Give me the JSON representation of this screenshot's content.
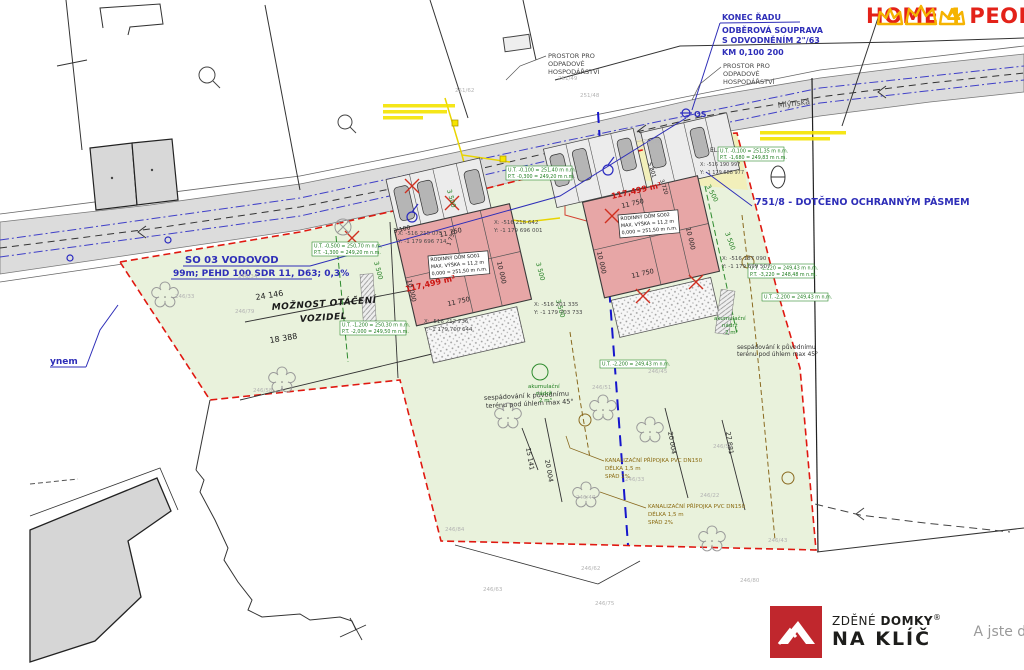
{
  "branding": {
    "home4people": {
      "home": "HOME",
      "four": "4",
      "people": "PEOPLE"
    },
    "naklic": {
      "zdene": "ZDĚNÉ",
      "domky": "DOMKY",
      "reg": "®",
      "naklic": "NA KLÍČ",
      "tagline": "A jste doma."
    }
  },
  "colors": {
    "accent_blue": "#2e2eb8",
    "parcel_green": "#e9f2dc",
    "building_pink": "#e7a6a6",
    "boundary_red": "#e01810",
    "road_gray": "#dcdcdc"
  },
  "buildings": {
    "so01": {
      "title": "RODINNÝ DŮM SO01",
      "height": "MAX. VÝŠKA = 11,2 m",
      "level": "0,000 = 251,50 m n.m.",
      "area": "117,499 m²"
    },
    "so02": {
      "title": "RODINNÝ DŮM SO02",
      "height": "MAX. VÝŠKA = 11,2 m",
      "level": "0,000 = 251,50 m n.m.",
      "area": "117,499 m²"
    }
  },
  "labels": [
    {
      "t": "KONEC ŘADU",
      "x": 722,
      "y": 20,
      "c": "blue",
      "s": 8,
      "n": "note-konec-radu"
    },
    {
      "t": "ODBĚROVÁ SOUPRAVA",
      "x": 722,
      "y": 33,
      "c": "blue",
      "s": 8,
      "n": "note-odberova-souprava"
    },
    {
      "t": "S ODVODNĚNÍM 2\"/63",
      "x": 722,
      "y": 43,
      "c": "blue",
      "s": 8,
      "n": "note-odvodneni"
    },
    {
      "t": "KM 0,100 200",
      "x": 722,
      "y": 55,
      "c": "blue",
      "s": 8,
      "n": "note-km"
    },
    {
      "t": "751/8 - DOTČENO OCHRANNÝM PÁSMEM",
      "x": 755,
      "y": 205,
      "c": "blue",
      "s": 9.5,
      "n": "note-ochranne-pasmo"
    },
    {
      "t": "SO 03 VODOVOD",
      "x": 185,
      "y": 263,
      "c": "blue",
      "s": 10,
      "n": "note-so03-vodovod"
    },
    {
      "t": "99m; PEHD 100 SDR 11, D63; 0,3%",
      "x": 173,
      "y": 276,
      "c": "blue",
      "s": 9,
      "n": "note-so03-spec"
    },
    {
      "t": "ynem",
      "x": 50,
      "y": 364,
      "c": "blue",
      "s": 9,
      "n": "note-ynem"
    },
    {
      "t": "OS",
      "x": 694,
      "y": 117,
      "c": "blue",
      "s": 8,
      "n": "note-os"
    },
    {
      "t": "PROSTOR PRO",
      "x": 548,
      "y": 58,
      "c": "note",
      "s": 6.5
    },
    {
      "t": "ODPADOVÉ",
      "x": 548,
      "y": 66,
      "c": "note",
      "s": 6.5
    },
    {
      "t": "HOSPODÁŘSTVÍ",
      "x": 548,
      "y": 74,
      "c": "note",
      "s": 6.5
    },
    {
      "t": "PROSTOR PRO",
      "x": 723,
      "y": 68,
      "c": "note",
      "s": 6.5
    },
    {
      "t": "ODPADOVÉ",
      "x": 723,
      "y": 76,
      "c": "note",
      "s": 6.5
    },
    {
      "t": "HOSPODÁŘSTVÍ",
      "x": 723,
      "y": 84,
      "c": "note",
      "s": 6.5
    },
    {
      "t": "Mlýnská",
      "x": 778,
      "y": 108,
      "r": -7,
      "c": "street",
      "s": 8,
      "n": "street-name"
    },
    {
      "t": "MOŽNOST OTÁČENÍ",
      "x": 272,
      "y": 310,
      "r": -4,
      "c": "blk-it",
      "s": 9,
      "n": "note-moznost-otaceni"
    },
    {
      "t": "VOZIDEL",
      "x": 300,
      "y": 322,
      "r": -4,
      "c": "blk-it",
      "s": 9
    },
    {
      "t": "sespádování k původnímu",
      "x": 484,
      "y": 400,
      "r": -3,
      "c": "blk",
      "s": 6.5
    },
    {
      "t": "terénu pod úhlem max 45°",
      "x": 486,
      "y": 408,
      "r": -3,
      "c": "blk",
      "s": 6.5
    },
    {
      "t": "sespádování k původnímu",
      "x": 737,
      "y": 349,
      "c": "blk",
      "s": 6
    },
    {
      "t": "terénu pod úhlem max 45°",
      "x": 737,
      "y": 356,
      "c": "blk",
      "s": 6
    },
    {
      "t": "117,499 m²",
      "x": 406,
      "y": 292,
      "r": -13,
      "c": "redtx",
      "s": 8,
      "n": "area-so01"
    },
    {
      "t": "117,499 m²",
      "x": 612,
      "y": 199,
      "r": -13,
      "c": "redtx",
      "s": 8,
      "n": "area-so02"
    },
    {
      "t": "11 750",
      "x": 440,
      "y": 237,
      "r": -13,
      "c": "dim",
      "s": 6.5
    },
    {
      "t": "11 750",
      "x": 448,
      "y": 306,
      "r": -13,
      "c": "dim",
      "s": 6.5
    },
    {
      "t": "11 750",
      "x": 622,
      "y": 208,
      "r": -13,
      "c": "dim",
      "s": 6.5
    },
    {
      "t": "11 750",
      "x": 632,
      "y": 278,
      "r": -13,
      "c": "dim",
      "s": 6.5
    },
    {
      "t": "10 000",
      "x": 407,
      "y": 280,
      "r": 77,
      "c": "dim",
      "s": 6.5
    },
    {
      "t": "10 000",
      "x": 497,
      "y": 262,
      "r": 77,
      "c": "dim",
      "s": 6.5
    },
    {
      "t": "10 000",
      "x": 597,
      "y": 252,
      "r": 77,
      "c": "dim",
      "s": 6.5
    },
    {
      "t": "10 000",
      "x": 686,
      "y": 228,
      "r": 77,
      "c": "dim",
      "s": 6.5
    },
    {
      "t": "3 100",
      "x": 394,
      "y": 233,
      "r": -13,
      "c": "dim",
      "s": 6
    },
    {
      "t": "24 146",
      "x": 256,
      "y": 300,
      "r": -9,
      "c": "dim",
      "s": 8
    },
    {
      "t": "18 388",
      "x": 270,
      "y": 343,
      "r": -9,
      "c": "dim",
      "s": 8
    },
    {
      "t": "20 004",
      "x": 545,
      "y": 460,
      "r": 80,
      "c": "dim",
      "s": 6.5
    },
    {
      "t": "20 004",
      "x": 668,
      "y": 432,
      "r": 80,
      "c": "dim",
      "s": 6.5
    },
    {
      "t": "15 141",
      "x": 526,
      "y": 448,
      "r": 80,
      "c": "dim",
      "s": 6.5
    },
    {
      "t": "27 881",
      "x": 726,
      "y": 432,
      "r": 82,
      "c": "dim",
      "s": 6.5
    },
    {
      "t": "3 720",
      "x": 660,
      "y": 180,
      "r": 72,
      "c": "dim",
      "s": 5.5
    },
    {
      "t": "5 801",
      "x": 648,
      "y": 163,
      "r": 72,
      "c": "dim",
      "s": 5.5
    },
    {
      "t": "1 750",
      "x": 450,
      "y": 246,
      "r": -70,
      "c": "dim",
      "s": 5.5
    },
    {
      "t": "3 500",
      "x": 447,
      "y": 190,
      "r": 75,
      "c": "dimG",
      "s": 6.5
    },
    {
      "t": "3 500",
      "x": 536,
      "y": 263,
      "r": 75,
      "c": "dimG",
      "s": 6.5
    },
    {
      "t": "3 500",
      "x": 706,
      "y": 186,
      "r": 62,
      "c": "dimG",
      "s": 6.5
    },
    {
      "t": "3 500",
      "x": 725,
      "y": 233,
      "r": 70,
      "c": "dimG",
      "s": 6.5
    },
    {
      "t": "3 500",
      "x": 374,
      "y": 262,
      "r": 75,
      "c": "dimG",
      "s": 6.5
    },
    {
      "t": "3 500",
      "x": 556,
      "y": 300,
      "r": 75,
      "c": "dimG",
      "s": 6.5
    },
    {
      "t": "akumulační",
      "x": 528,
      "y": 388,
      "c": "grn",
      "s": 5.5,
      "n": "note-akumulacni-nadrz"
    },
    {
      "t": "nádrž",
      "x": 536,
      "y": 395,
      "c": "grn",
      "s": 5.5
    },
    {
      "t": "2 m³",
      "x": 539,
      "y": 402,
      "c": "grn",
      "s": 5.5
    },
    {
      "t": "akumulační",
      "x": 714,
      "y": 320,
      "c": "grn",
      "s": 5.5,
      "n": "note-akumulacni-nadrz"
    },
    {
      "t": "nádrž",
      "x": 722,
      "y": 327,
      "c": "grn",
      "s": 5.5
    },
    {
      "t": "2 m³",
      "x": 725,
      "y": 334,
      "c": "grn",
      "s": 5.5
    },
    {
      "t": "KANALIZAČNÍ PŘÍPOJKA PVC DN150",
      "x": 605,
      "y": 462,
      "c": "brn",
      "s": 5.5,
      "n": "note-kanalizace-1"
    },
    {
      "t": "DÉLKA 1,5 m",
      "x": 605,
      "y": 470,
      "c": "brn",
      "s": 5.5
    },
    {
      "t": "SPÁD 2%",
      "x": 605,
      "y": 478,
      "c": "brn",
      "s": 5.5
    },
    {
      "t": "KANALIZAČNÍ PŘÍPOJKA PVC DN150",
      "x": 648,
      "y": 508,
      "c": "brn",
      "s": 5.5,
      "n": "note-kanalizace-2"
    },
    {
      "t": "DÉLKA 1,5 m",
      "x": 648,
      "y": 516,
      "c": "brn",
      "s": 5.5
    },
    {
      "t": "SPÁD 2%",
      "x": 648,
      "y": 524,
      "c": "brn",
      "s": 5.5
    },
    {
      "t": "X: -516 215 075",
      "x": 398,
      "y": 235,
      "c": "coord",
      "s": 5.5
    },
    {
      "t": "Y: -1 179 696 714",
      "x": 398,
      "y": 243,
      "c": "coord",
      "s": 5.5
    },
    {
      "t": "X: -516 218 642",
      "x": 494,
      "y": 224,
      "c": "coord",
      "s": 5.5
    },
    {
      "t": "Y: -1 179 696 001",
      "x": 494,
      "y": 232,
      "c": "coord",
      "s": 5.5
    },
    {
      "t": "X: -516 212 736",
      "x": 424,
      "y": 323,
      "c": "coord",
      "s": 5.5
    },
    {
      "t": "Y: -1 179 700 644",
      "x": 424,
      "y": 331,
      "c": "coord",
      "s": 5.5
    },
    {
      "t": "X: -516 201 335",
      "x": 534,
      "y": 306,
      "c": "coord",
      "s": 5.5
    },
    {
      "t": "Y: -1 179 703 733",
      "x": 534,
      "y": 314,
      "c": "coord",
      "s": 5.5
    },
    {
      "t": "X: -516 187 090",
      "x": 722,
      "y": 260,
      "c": "coord",
      "s": 5.5
    },
    {
      "t": "Y: -1 179 699 507",
      "x": 722,
      "y": 268,
      "c": "coord",
      "s": 5.5
    },
    {
      "t": "X: -516 190 997",
      "x": 700,
      "y": 166,
      "c": "coord",
      "s": 5
    },
    {
      "t": "Y: -1 179 688 977",
      "x": 700,
      "y": 174,
      "c": "coord",
      "s": 5
    },
    {
      "t": "EL.",
      "x": 710,
      "y": 152,
      "c": "blk",
      "s": 6,
      "n": "note-el"
    },
    {
      "t": "251/62",
      "x": 455,
      "y": 92,
      "c": "parcel",
      "s": 5.5
    },
    {
      "t": "251/48",
      "x": 580,
      "y": 97,
      "c": "parcel",
      "s": 5.5
    },
    {
      "t": "251/49",
      "x": 558,
      "y": 80,
      "c": "parcel",
      "s": 5.5
    },
    {
      "t": "251/19",
      "x": 643,
      "y": 143,
      "c": "parcel",
      "s": 5
    },
    {
      "t": "246/34",
      "x": 238,
      "y": 278,
      "c": "parcel",
      "s": 5.5
    },
    {
      "t": "246/33",
      "x": 175,
      "y": 298,
      "c": "parcel",
      "s": 5.5
    },
    {
      "t": "246/79",
      "x": 235,
      "y": 313,
      "c": "parcel",
      "s": 5.5
    },
    {
      "t": "246/58",
      "x": 253,
      "y": 392,
      "c": "parcel",
      "s": 5.5
    },
    {
      "t": "246/51",
      "x": 592,
      "y": 389,
      "c": "parcel",
      "s": 5.5
    },
    {
      "t": "246/45",
      "x": 648,
      "y": 373,
      "c": "parcel",
      "s": 5.5
    },
    {
      "t": "246/47",
      "x": 576,
      "y": 499,
      "c": "parcel",
      "s": 5.5
    },
    {
      "t": "246/22",
      "x": 700,
      "y": 497,
      "c": "parcel",
      "s": 5.5
    },
    {
      "t": "246/59",
      "x": 713,
      "y": 448,
      "c": "parcel",
      "s": 5.5
    },
    {
      "t": "246/33",
      "x": 625,
      "y": 481,
      "c": "parcel",
      "s": 5.5
    },
    {
      "t": "246/43",
      "x": 768,
      "y": 542,
      "c": "parcel",
      "s": 5.5
    },
    {
      "t": "246/84",
      "x": 445,
      "y": 531,
      "c": "parcel",
      "s": 5.5
    },
    {
      "t": "246/62",
      "x": 581,
      "y": 570,
      "c": "parcel",
      "s": 5.5
    },
    {
      "t": "246/63",
      "x": 483,
      "y": 591,
      "c": "parcel",
      "s": 5.5
    },
    {
      "t": "246/75",
      "x": 595,
      "y": 605,
      "c": "parcel",
      "s": 5.5
    },
    {
      "t": "246/80",
      "x": 740,
      "y": 582,
      "c": "parcel",
      "s": 5.5
    }
  ],
  "boxes": [
    {
      "x": 428,
      "y": 256,
      "w": 60,
      "h": 23,
      "r": -5,
      "c": "bldg",
      "n": "label-box-so01",
      "lines": [
        "RODINNÝ DŮM SO01",
        "MAX. VÝŠKA = 11,2 m",
        "0,000 = 251,50 m n.m."
      ]
    },
    {
      "x": 618,
      "y": 215,
      "w": 60,
      "h": 23,
      "r": -5,
      "c": "bldg",
      "n": "label-box-so02",
      "lines": [
        "RODINNÝ DŮM SO02",
        "MAX. VÝŠKA = 11,2 m",
        "0,000 = 251,50 m n.m."
      ]
    },
    {
      "x": 718,
      "y": 147,
      "w": 66,
      "h": 14,
      "c": "elev",
      "lines": [
        "U.T. -0,100 = 251,35 m n.m.",
        "P.T. -1,680 = 249,83 m n.m."
      ]
    },
    {
      "x": 748,
      "y": 264,
      "w": 66,
      "h": 14,
      "c": "elev",
      "lines": [
        "U.T. -2,220 = 249,43 m n.m.",
        "P.T. -3,220 = 248,48 m n.m."
      ]
    },
    {
      "x": 762,
      "y": 293,
      "w": 66,
      "h": 8,
      "c": "elev",
      "lines": [
        "U.T. -2,200 = 249,43 m n.m."
      ]
    },
    {
      "x": 312,
      "y": 242,
      "w": 66,
      "h": 14,
      "c": "elev",
      "lines": [
        "U.T. -0,500 = 250,70 m n.m.",
        "P.T. -1,300 = 249,20 m n.m."
      ]
    },
    {
      "x": 340,
      "y": 321,
      "w": 66,
      "h": 14,
      "c": "elev",
      "lines": [
        "U.T. -1,200 = 250,30 m n.m.",
        "P.T. -2,000 = 249,50 m n.m."
      ]
    },
    {
      "x": 506,
      "y": 166,
      "w": 66,
      "h": 14,
      "c": "elev",
      "lines": [
        "U.T. -0,100 = 251,40 m n.m.",
        "P.T. -0,300 = 249,20 m n.m."
      ]
    },
    {
      "x": 600,
      "y": 360,
      "w": 66,
      "h": 8,
      "c": "elev",
      "lines": [
        "U.T. -2,200 = 249,43 m n.m."
      ]
    }
  ]
}
